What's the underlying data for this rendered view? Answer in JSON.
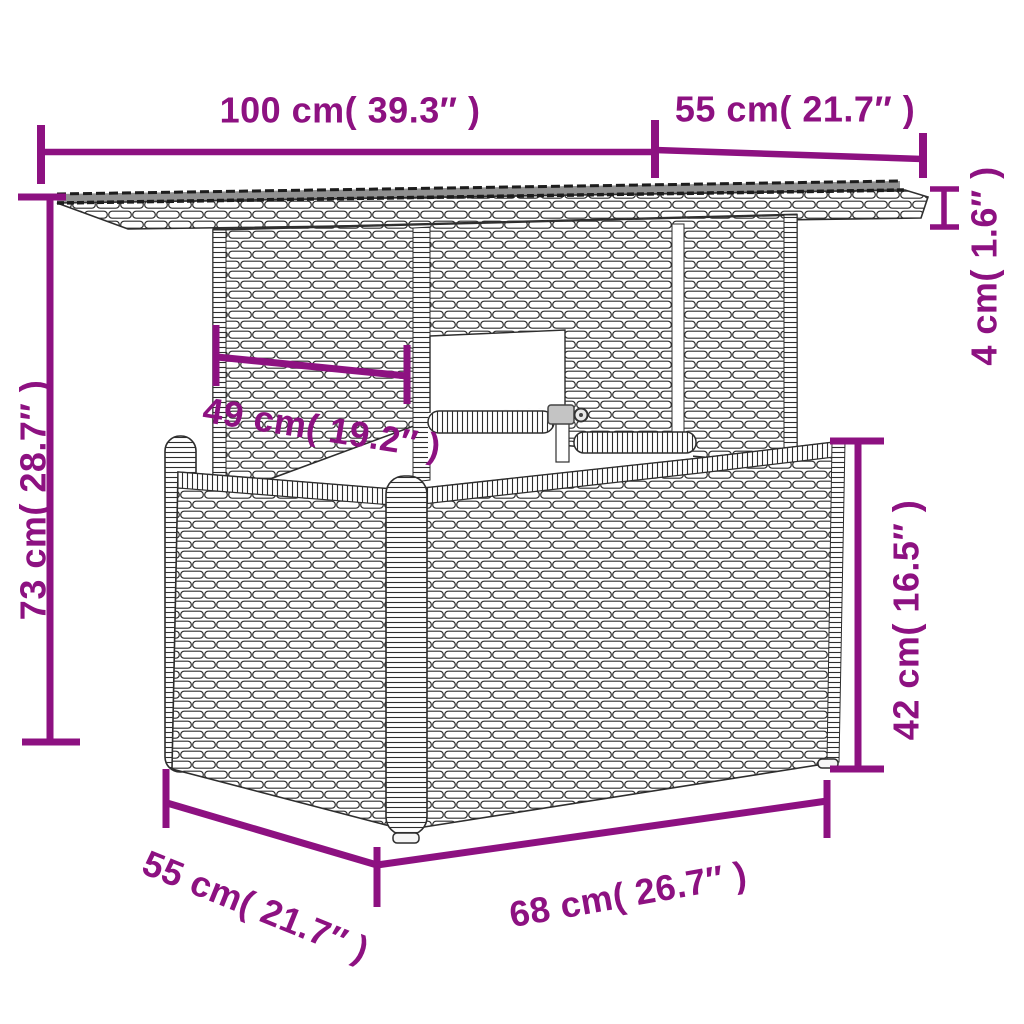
{
  "diagram": {
    "subject": "poly-rattan garden table dimension drawing",
    "colors": {
      "dimension": "#8D1181",
      "line_art": "#2E2E2E",
      "glass_top": "#909090",
      "background": "#FFFFFF"
    },
    "labels": {
      "top_width": "100 cm( 39.3″ )",
      "top_depth": "55 cm( 21.7″ )",
      "top_thickness": "4 cm( 1.6″ )",
      "overall_height": "73 cm( 28.7″ )",
      "pedestal_width": "49 cm( 19.2″ )",
      "base_height": "42 cm( 16.5″ )",
      "base_depth": "55 cm( 21.7″ )",
      "base_width": "68 cm( 26.7″ )"
    }
  }
}
